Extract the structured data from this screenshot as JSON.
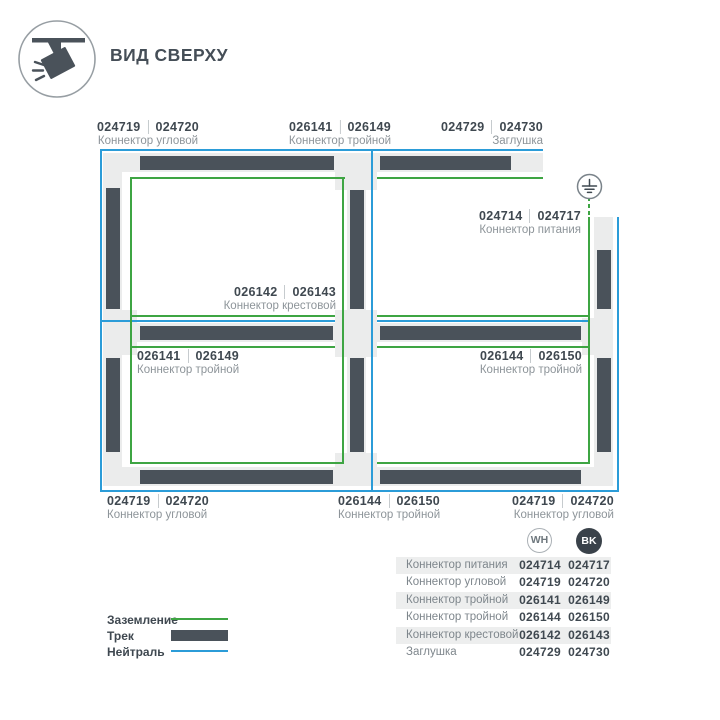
{
  "header": {
    "title": "ВИД СВЕРХУ"
  },
  "diagram": {
    "labels": {
      "top_corner": {
        "num_wh": "024719",
        "num_bk": "024720",
        "name": "Коннектор угловой"
      },
      "top_triple": {
        "num_wh": "026141",
        "num_bk": "026149",
        "name": "Коннектор тройной"
      },
      "top_cap": {
        "num_wh": "024729",
        "num_bk": "024730",
        "name": "Заглушка"
      },
      "power": {
        "num_wh": "024714",
        "num_bk": "024717",
        "name": "Коннектор питания"
      },
      "cross": {
        "num_wh": "026142",
        "num_bk": "026143",
        "name": "Коннектор крестовой"
      },
      "bl_triple": {
        "num_wh": "026141",
        "num_bk": "026149",
        "name": "Коннектор тройной"
      },
      "br_triple": {
        "num_wh": "026144",
        "num_bk": "026150",
        "name": "Коннектор тройной"
      },
      "bottom_corner_left": {
        "num_wh": "024719",
        "num_bk": "024720",
        "name": "Коннектор угловой"
      },
      "bottom_triple": {
        "num_wh": "026144",
        "num_bk": "026150",
        "name": "Коннектор тройной"
      },
      "bottom_corner_right": {
        "num_wh": "024719",
        "num_bk": "024720",
        "name": "Коннектор угловой"
      }
    }
  },
  "legend": {
    "items": [
      {
        "label": "Заземление",
        "type": "ground"
      },
      {
        "label": "Трек",
        "type": "track"
      },
      {
        "label": "Нейтраль",
        "type": "neutral"
      }
    ]
  },
  "table": {
    "col_wh": "WH",
    "col_bk": "BK",
    "rows": [
      {
        "name": "Коннектор питания",
        "wh": "024714",
        "bk": "024717"
      },
      {
        "name": "Коннектор угловой",
        "wh": "024719",
        "bk": "024720"
      },
      {
        "name": "Коннектор тройной",
        "wh": "026141",
        "bk": "026149"
      },
      {
        "name": "Коннектор тройной",
        "wh": "026144",
        "bk": "026150"
      },
      {
        "name": "Коннектор крестовой",
        "wh": "026142",
        "bk": "026143"
      },
      {
        "name": "Заглушка",
        "wh": "024729",
        "bk": "024730"
      }
    ]
  },
  "colors": {
    "ground_green": "#3ea543",
    "neutral_blue": "#2b9cd8",
    "track_dark": "#4a525a",
    "track_bed": "#ebecec"
  }
}
